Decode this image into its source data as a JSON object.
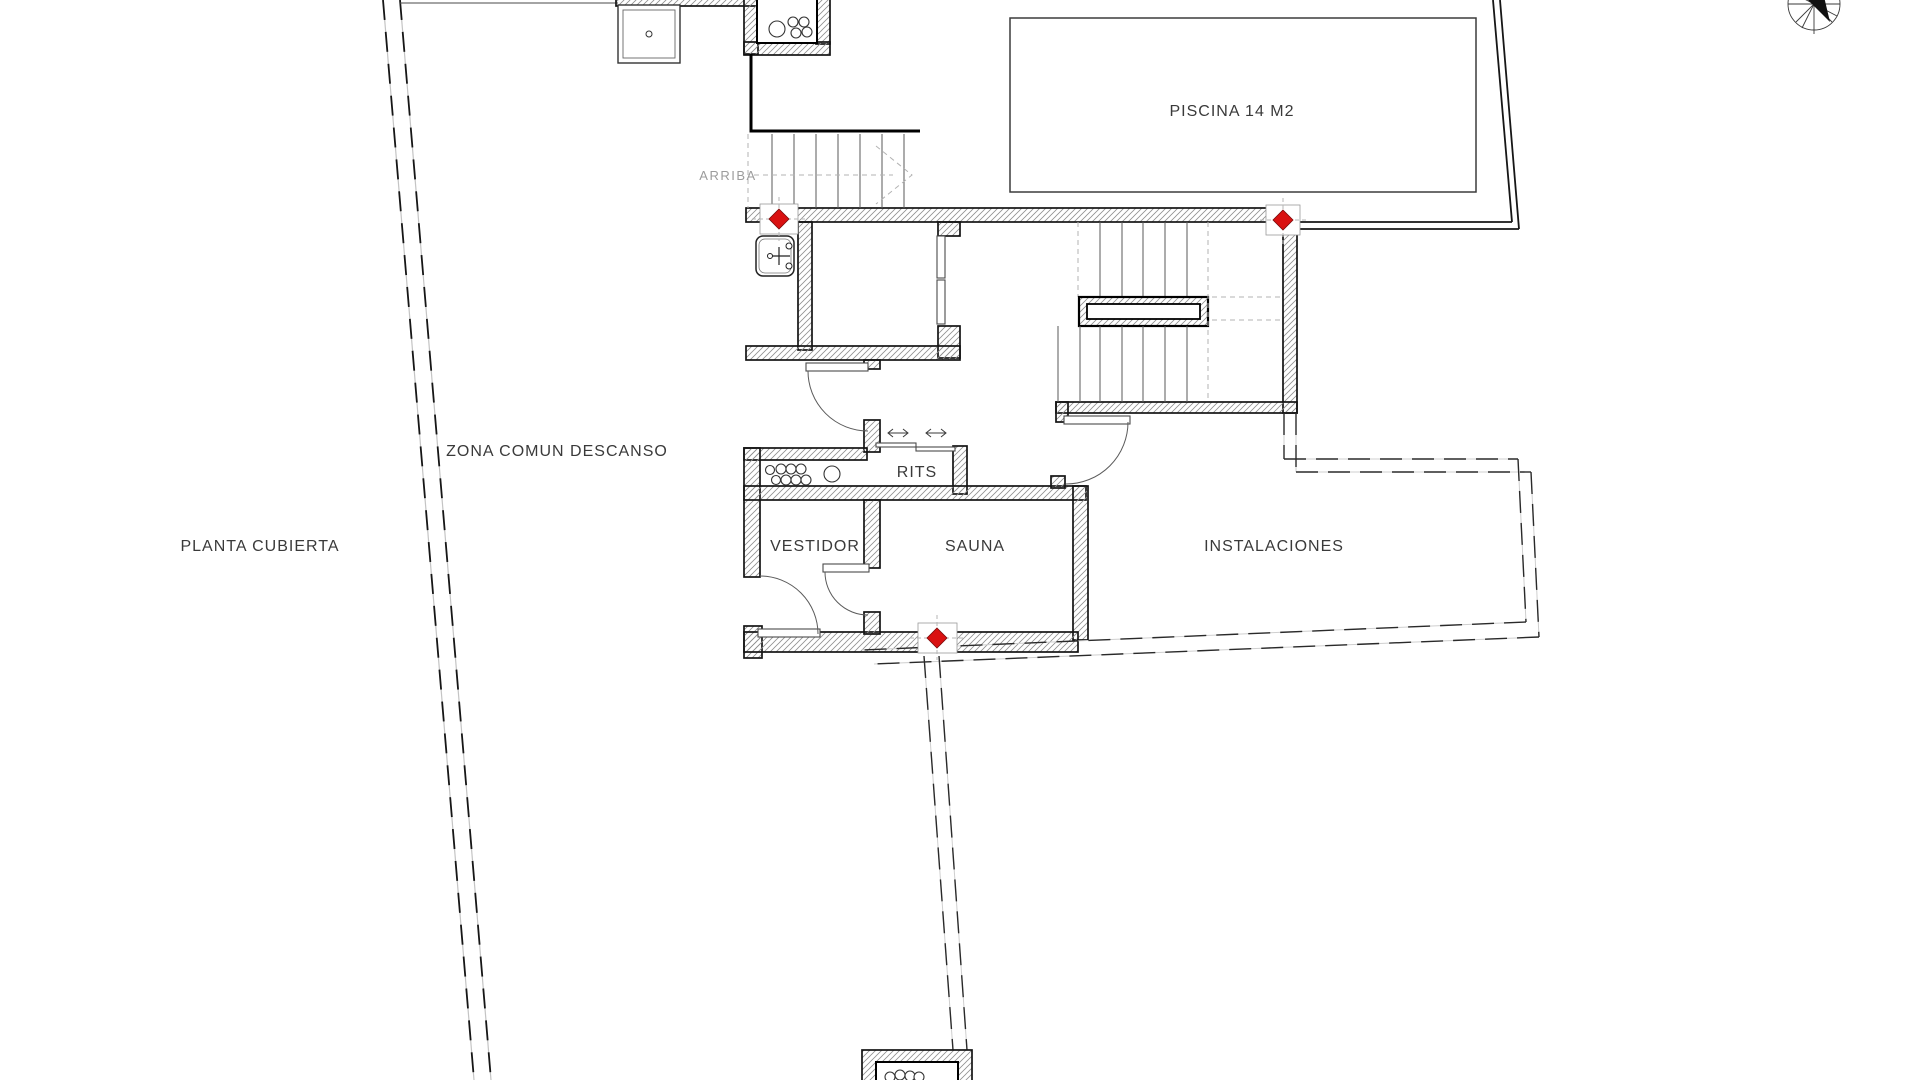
{
  "drawing": {
    "title": "PLANTA CUBIERTA",
    "type": "architectural-roof-plan"
  },
  "labels": {
    "plan_title": "PLANTA CUBIERTA",
    "zona_comun": "ZONA COMUN DESCANSO",
    "arriba": "ARRIBA",
    "piscina": "PISCINA 14 M2",
    "rits": "RITS",
    "vestidor": "VESTIDOR",
    "sauna": "SAUNA",
    "instalaciones": "INSTALACIONES"
  },
  "markers": {
    "color": "#d91111",
    "count": 3,
    "meaning": "control-point-diamond"
  },
  "colors": {
    "wall_line": "#141414",
    "hatch": "#8f8f8f",
    "dashed_boundary": "#161616",
    "text": "#3a3a3a",
    "secondary_text": "#9c9c9c",
    "background": "#ffffff"
  }
}
